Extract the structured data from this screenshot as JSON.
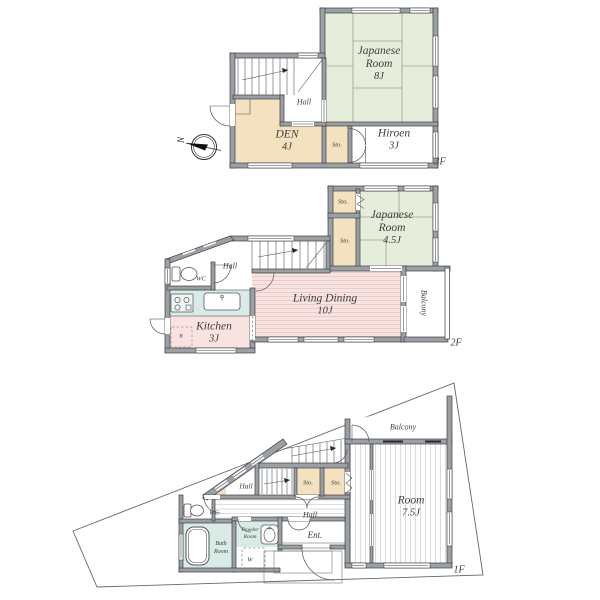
{
  "colors": {
    "wall_gray": "#9ba0a5",
    "tatami_green": "#e6eedb",
    "wood_tan": "#f4e1c0",
    "ldk_pink": "#f9e3e1",
    "bath_teal": "#d9ebe6",
    "lot_line": "#666666"
  },
  "f3": {
    "floor_label": "3F",
    "compass_north": "N",
    "rooms": {
      "japanese": {
        "l1": "Japanese",
        "l2": "Room",
        "size": "8J"
      },
      "hall": "Hall",
      "den": {
        "name": "DEN",
        "size": "4J"
      },
      "sto": "Sto.",
      "hiroen": {
        "name": "Hiroen",
        "size": "3J"
      }
    }
  },
  "f2": {
    "floor_label": "2F",
    "rooms": {
      "sto1": "Sto.",
      "sto2": "Sto.",
      "japanese": {
        "l1": "Japanese",
        "l2": "Room",
        "size": "4.5J"
      },
      "hall": "Hall",
      "wc": "WC",
      "living": {
        "name": "Living Dining",
        "size": "10J"
      },
      "kitchen": {
        "name": "Kitchen",
        "size": "3J"
      },
      "fridge": "R",
      "balcony": "Balcony"
    }
  },
  "f1": {
    "floor_label": "1F",
    "rooms": {
      "balcony": "Balcony",
      "hall_upper": "Hall",
      "sto1": "Sto.",
      "sto2": "Sto.",
      "room": {
        "name": "Room",
        "size": "7.5J"
      },
      "wc": "WC",
      "hall": "Hall",
      "bath": {
        "l1": "Bath",
        "l2": "Room"
      },
      "powder": {
        "l1": "Powder",
        "l2": "Room"
      },
      "washer": "W",
      "entrance": "Ent."
    }
  }
}
